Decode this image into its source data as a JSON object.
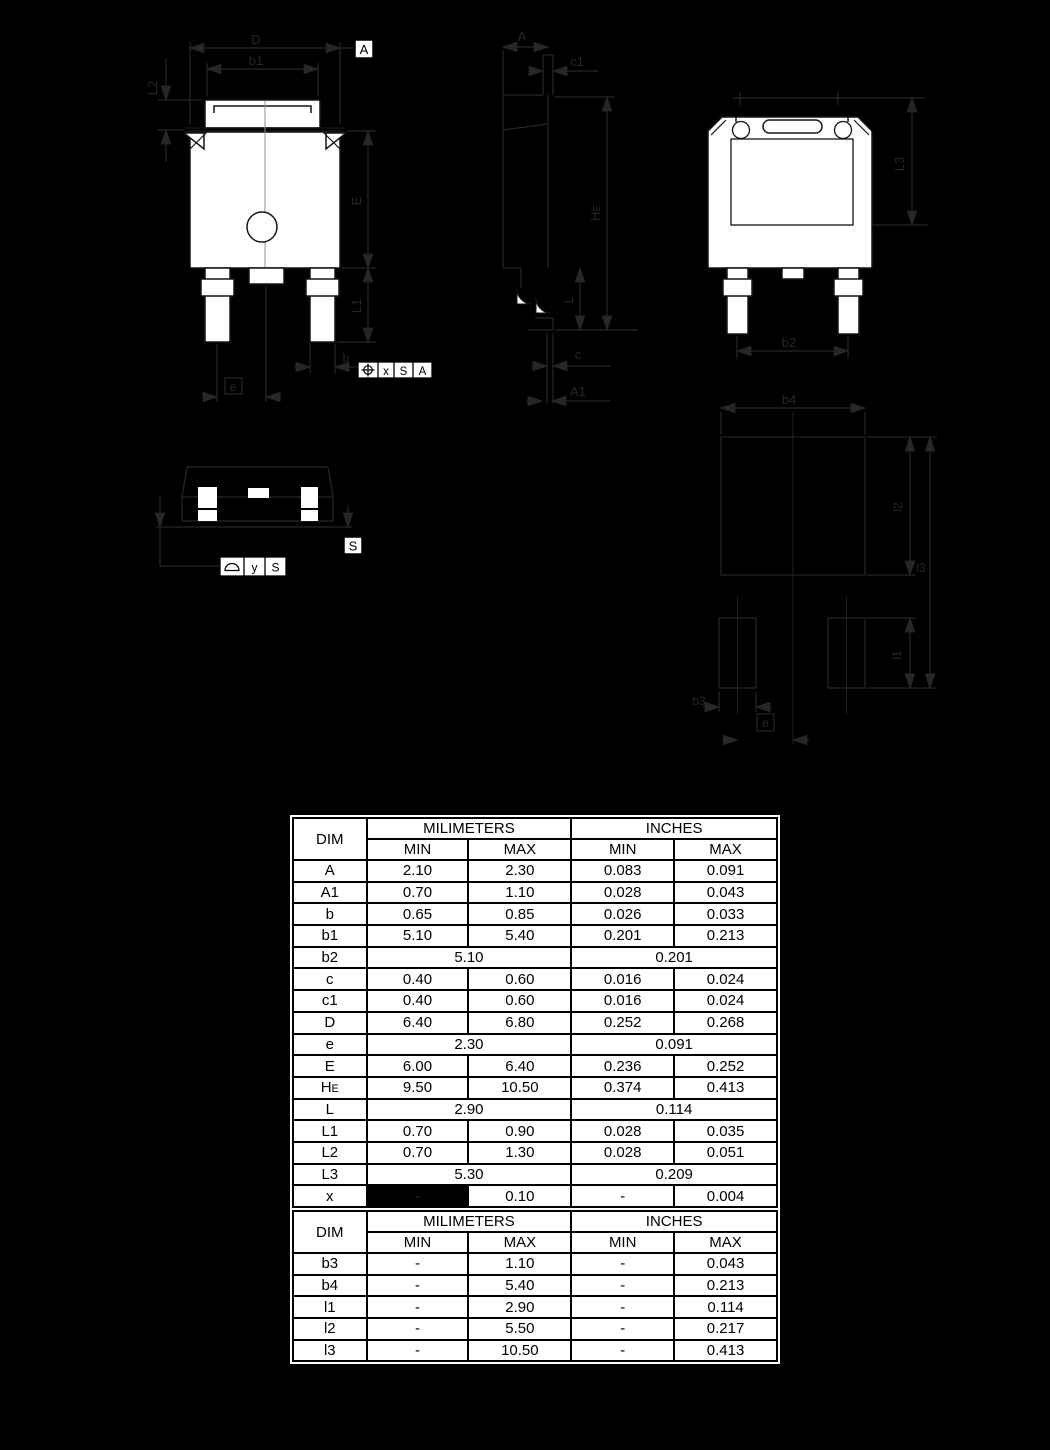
{
  "page": {
    "background": "#000000",
    "drawing_line_color": "#2b2524",
    "body_fill": "#ffffff",
    "outline_color": "#151515"
  },
  "views": {
    "front_view": {
      "dims": {
        "d": "D",
        "b1": "b1",
        "l2": "L2",
        "e_body": "E",
        "l1": "L1",
        "b": "b",
        "e_pitch": "e"
      },
      "datum_flag": "A",
      "fcf_position": {
        "symbol_glyph": "⌖",
        "tolerance": "x",
        "datum_1": "S",
        "datum_2": "A"
      }
    },
    "side_view": {
      "dims": {
        "a": "A",
        "c1": "c1",
        "he_main": "H",
        "he_sub": "E",
        "l": "L",
        "c": "c",
        "a1": "A1"
      }
    },
    "back_view": {
      "dims": {
        "l3": "L3",
        "b2": "b2",
        "b4": "b4"
      }
    },
    "bottom_view": {
      "datum_flag": "S",
      "fcf_profile": {
        "symbol_glyph": "⌓",
        "tolerance": "y",
        "datum_1": "S"
      }
    },
    "footprint_view": {
      "dims": {
        "l2": "l2",
        "l3": "l3",
        "l1": "l1",
        "b3": "b3",
        "e": "e"
      }
    }
  },
  "tables": [
    {
      "headers": {
        "dim": "DIM",
        "mm": "MILIMETERS",
        "inches": "INCHES",
        "min": "MIN",
        "max": "MAX"
      },
      "rows": [
        {
          "dim": "A",
          "mm_min": "2.10",
          "mm_max": "2.30",
          "in_min": "0.083",
          "in_max": "0.091"
        },
        {
          "dim": "A1",
          "mm_min": "0.70",
          "mm_max": "1.10",
          "in_min": "0.028",
          "in_max": "0.043"
        },
        {
          "dim": "b",
          "mm_min": "0.65",
          "mm_max": "0.85",
          "in_min": "0.026",
          "in_max": "0.033"
        },
        {
          "dim": "b1",
          "mm_min": "5.10",
          "mm_max": "5.40",
          "in_min": "0.201",
          "in_max": "0.213"
        },
        {
          "dim": "b2",
          "span": true,
          "mm_span": "5.10",
          "in_span": "0.201"
        },
        {
          "dim": "c",
          "mm_min": "0.40",
          "mm_max": "0.60",
          "in_min": "0.016",
          "in_max": "0.024"
        },
        {
          "dim": "c1",
          "mm_min": "0.40",
          "mm_max": "0.60",
          "in_min": "0.016",
          "in_max": "0.024"
        },
        {
          "dim": "D",
          "mm_min": "6.40",
          "mm_max": "6.80",
          "in_min": "0.252",
          "in_max": "0.268"
        },
        {
          "dim": "e",
          "span": true,
          "mm_span": "2.30",
          "in_span": "0.091"
        },
        {
          "dim": "E",
          "mm_min": "6.00",
          "mm_max": "6.40",
          "in_min": "0.236",
          "in_max": "0.252"
        },
        {
          "dim": "HE",
          "dim_subscript_last": true,
          "mm_min": "9.50",
          "mm_max": "10.50",
          "in_min": "0.374",
          "in_max": "0.413"
        },
        {
          "dim": "L",
          "span": true,
          "mm_span": "2.90",
          "in_span": "0.114"
        },
        {
          "dim": "L1",
          "mm_min": "0.70",
          "mm_max": "0.90",
          "in_min": "0.028",
          "in_max": "0.035"
        },
        {
          "dim": "L2",
          "mm_min": "0.70",
          "mm_max": "1.30",
          "in_min": "0.028",
          "in_max": "0.051"
        },
        {
          "dim": "L3",
          "span": true,
          "mm_span": "5.30",
          "in_span": "0.209"
        },
        {
          "dim": "x",
          "mm_min": "-",
          "mm_min_blacked": true,
          "mm_max": "0.10",
          "in_min": "-",
          "in_max": "0.004"
        },
        {
          "dim": "y",
          "mm_min": "-",
          "mm_min_blacked": true,
          "mm_max": "0.10",
          "in_min": "-",
          "in_max": "0.004"
        }
      ]
    },
    {
      "headers": {
        "dim": "DIM",
        "mm": "MILIMETERS",
        "inches": "INCHES",
        "min": "MIN",
        "max": "MAX"
      },
      "rows": [
        {
          "dim": "b3",
          "mm_min": "-",
          "mm_max": "1.10",
          "in_min": "-",
          "in_max": "0.043"
        },
        {
          "dim": "b4",
          "mm_min": "-",
          "mm_max": "5.40",
          "in_min": "-",
          "in_max": "0.213"
        },
        {
          "dim": "l1",
          "mm_min": "-",
          "mm_max": "2.90",
          "in_min": "-",
          "in_max": "0.114"
        },
        {
          "dim": "l2",
          "mm_min": "-",
          "mm_max": "5.50",
          "in_min": "-",
          "in_max": "0.217"
        },
        {
          "dim": "l3",
          "mm_min": "-",
          "mm_max": "10.50",
          "in_min": "-",
          "in_max": "0.413"
        }
      ]
    }
  ]
}
